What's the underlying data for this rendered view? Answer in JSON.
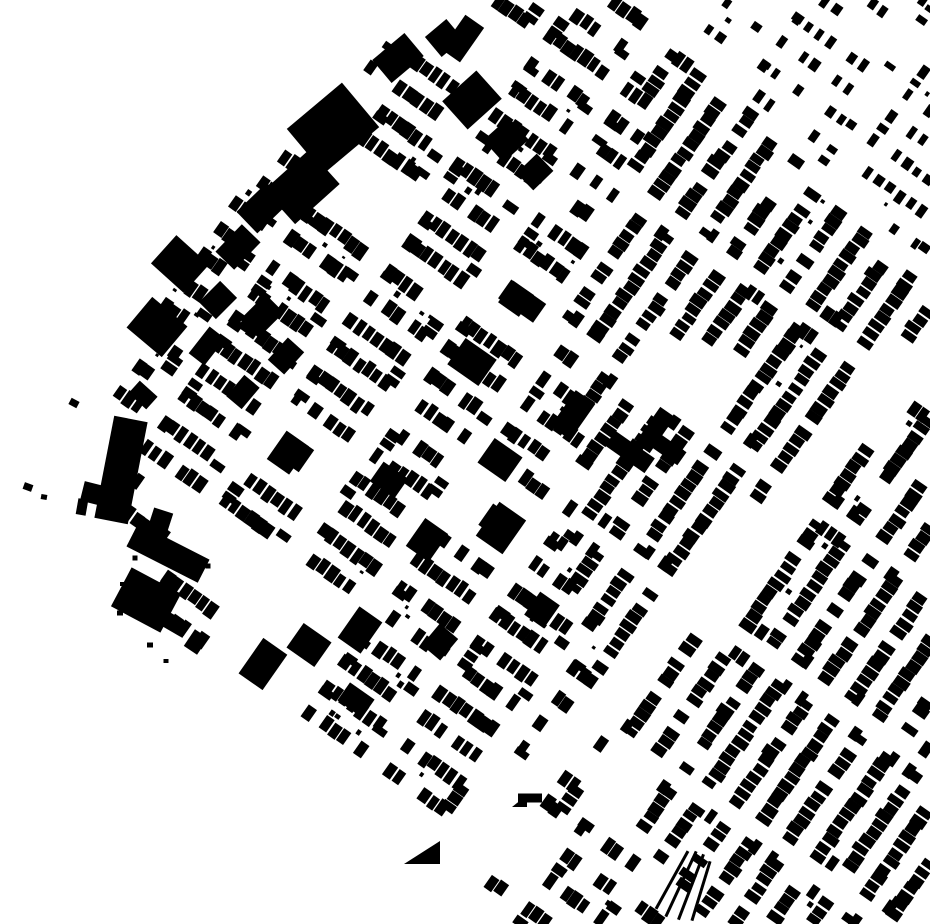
{
  "meta": {
    "description": "Black and white figure-ground map of urban building footprints: dense diagonal row-house grid, large industrial buildings along a north-west waterfront edge, a wide diagonal boulevard crossing the south-east, an empty park block right of center, a junction plaza at bottom and curved rail tracks at bottom center",
    "type": "figure-ground-map",
    "background": "#ffffff",
    "ink": "#000000",
    "width": 930,
    "height": 924,
    "seed": 1337
  },
  "districts": [
    {
      "name": "central-grid",
      "rotation": 35,
      "block_pitch_along": 96,
      "block_length": 80,
      "block_pitch_across": 63,
      "block_width": 45,
      "house_pitch": 10.5,
      "house_width": [
        7.5,
        11
      ],
      "house_depth": [
        13,
        16.5
      ],
      "skip_prob": 0.15,
      "end_prob": 0.35,
      "big_prob": 0.05,
      "empty_prob": 0.03,
      "speck_prob": 0.5,
      "phase": [
        12,
        8
      ],
      "polygon": [
        [
          430,
          0
        ],
        [
          648,
          0
        ],
        [
          648,
          128
        ],
        [
          610,
          210
        ],
        [
          560,
          300
        ],
        [
          590,
          430
        ],
        [
          560,
          560
        ],
        [
          612,
          700
        ],
        [
          578,
          764
        ],
        [
          700,
          924
        ],
        [
          520,
          924
        ],
        [
          470,
          860
        ],
        [
          420,
          810
        ],
        [
          330,
          755
        ],
        [
          225,
          695
        ],
        [
          160,
          620
        ],
        [
          95,
          540
        ],
        [
          103,
          418
        ],
        [
          148,
          340
        ],
        [
          185,
          265
        ],
        [
          255,
          180
        ],
        [
          340,
          95
        ]
      ]
    },
    {
      "name": "southeast-grid",
      "rotation": -55,
      "block_pitch_along": 150,
      "block_length": 134,
      "block_pitch_across": 64,
      "block_width": 47,
      "house_pitch": 10,
      "house_width": [
        7.5,
        10.5
      ],
      "house_depth": [
        13,
        16.5
      ],
      "skip_prob": 0.09,
      "end_prob": 0.4,
      "big_prob": 0.035,
      "empty_prob": 0.02,
      "speck_prob": 0.35,
      "phase": [
        30,
        6
      ],
      "polygon": [
        [
          648,
          0
        ],
        [
          930,
          290
        ],
        [
          930,
          924
        ],
        [
          706,
          924
        ],
        [
          582,
          762
        ],
        [
          612,
          700
        ],
        [
          560,
          560
        ],
        [
          590,
          430
        ],
        [
          560,
          300
        ],
        [
          610,
          210
        ],
        [
          648,
          128
        ]
      ]
    },
    {
      "name": "northeast-grid",
      "rotation": 35,
      "block_pitch_along": 132,
      "block_length": 114,
      "block_pitch_across": 57,
      "block_width": 41,
      "house_pitch": 13.5,
      "house_width": [
        6,
        9.5
      ],
      "house_depth": [
        9,
        13
      ],
      "skip_prob": 0.33,
      "end_prob": 0.25,
      "big_prob": 0.03,
      "empty_prob": 0.06,
      "speck_prob": 0.5,
      "phase": [
        55,
        20
      ],
      "polygon": [
        [
          646,
          0
        ],
        [
          930,
          0
        ],
        [
          930,
          292
        ]
      ]
    }
  ],
  "streets": [
    {
      "name": "boulevard-upper",
      "points": [
        [
          945,
          332
        ],
        [
          758,
          530
        ],
        [
          608,
          702
        ]
      ],
      "width": 46
    },
    {
      "name": "boulevard-lower",
      "points": [
        [
          608,
          702
        ],
        [
          560,
          756
        ],
        [
          468,
          830
        ],
        [
          352,
          924
        ]
      ],
      "width": 38
    },
    {
      "name": "south-branch",
      "points": [
        [
          574,
          760
        ],
        [
          700,
          932
        ]
      ],
      "width": 24
    },
    {
      "name": "park-block",
      "points": [
        [
          655,
          380
        ],
        [
          700,
          380
        ]
      ],
      "width": 76
    },
    {
      "name": "junction-plaza",
      "points": [
        [
          548,
          745
        ],
        [
          636,
          782
        ]
      ],
      "width": 40
    },
    {
      "name": "northeast-boundary-street",
      "points": [
        [
          648,
          -6
        ],
        [
          936,
          290
        ]
      ],
      "width": 16
    },
    {
      "name": "northeast-diagonal-street",
      "points": [
        [
          862,
          -5
        ],
        [
          800,
          120
        ],
        [
          770,
          230
        ]
      ],
      "width": 13
    }
  ],
  "landmarks": [
    [
      333,
      128,
      58,
      72,
      50
    ],
    [
      302,
      187,
      46,
      60,
      48
    ],
    [
      262,
      208,
      30,
      42,
      46
    ],
    [
      238,
      247,
      26,
      38,
      44
    ],
    [
      180,
      264,
      44,
      38,
      42
    ],
    [
      218,
      300,
      24,
      30,
      45
    ],
    [
      262,
      316,
      26,
      36,
      45
    ],
    [
      286,
      356,
      22,
      30,
      42
    ],
    [
      157,
      327,
      46,
      40,
      40
    ],
    [
      207,
      346,
      20,
      34,
      38
    ],
    [
      243,
      392,
      20,
      28,
      40
    ],
    [
      143,
      395,
      24,
      17,
      42
    ],
    [
      121,
      470,
      34,
      104,
      11
    ],
    [
      160,
      522,
      20,
      24,
      18
    ],
    [
      168,
      553,
      80,
      26,
      27
    ],
    [
      146,
      600,
      56,
      44,
      28
    ],
    [
      176,
      625,
      24,
      16,
      30
    ],
    [
      196,
      642,
      16,
      20,
      34
    ],
    [
      398,
      58,
      30,
      42,
      50
    ],
    [
      444,
      38,
      26,
      28,
      50
    ],
    [
      472,
      100,
      38,
      46,
      48
    ],
    [
      506,
      140,
      30,
      34,
      48
    ],
    [
      535,
      172,
      24,
      28,
      46
    ],
    [
      360,
      630,
      38,
      28,
      -55
    ],
    [
      440,
      642,
      28,
      24,
      -50
    ],
    [
      472,
      362,
      38,
      32,
      35
    ],
    [
      500,
      460,
      34,
      30,
      35
    ],
    [
      427,
      540,
      28,
      34,
      35
    ],
    [
      573,
      415,
      24,
      44,
      35
    ],
    [
      630,
      452,
      48,
      18,
      35
    ],
    [
      389,
      480,
      24,
      30,
      -55
    ],
    [
      309,
      645,
      30,
      34,
      -55
    ],
    [
      542,
      610,
      24,
      28,
      35
    ],
    [
      356,
      700,
      30,
      22,
      35
    ],
    [
      655,
      430,
      18,
      44,
      35
    ],
    [
      668,
      449,
      34,
      16,
      35
    ],
    [
      530,
      798,
      24,
      9,
      0
    ]
  ],
  "special_polygons": [
    {
      "name": "triangle-building",
      "points": [
        [
          404,
          864
        ],
        [
          440,
          841
        ],
        [
          440,
          864
        ]
      ]
    },
    {
      "name": "triangle-building-small",
      "points": [
        [
          512,
          807
        ],
        [
          527,
          795
        ],
        [
          527,
          807
        ]
      ]
    }
  ],
  "rails": [
    [
      672,
      880,
      3,
      66,
      29
    ],
    [
      681,
      884,
      3,
      72,
      25
    ],
    [
      691,
      887,
      3,
      70,
      21
    ],
    [
      701,
      891,
      3,
      62,
      17
    ]
  ],
  "scatter": [
    [
      28,
      487,
      9,
      7,
      20
    ],
    [
      44,
      497,
      6,
      5,
      10
    ],
    [
      95,
      494,
      26,
      20,
      14
    ],
    [
      82,
      507,
      10,
      16,
      10
    ],
    [
      74,
      403,
      9,
      7,
      28
    ],
    [
      135,
      558,
      5,
      5,
      0
    ],
    [
      122,
      584,
      4,
      4,
      0
    ],
    [
      150,
      645,
      6,
      5,
      0
    ],
    [
      166,
      661,
      5,
      4,
      0
    ],
    [
      208,
      566,
      5,
      5,
      0
    ],
    [
      120,
      613,
      6,
      5,
      0
    ]
  ]
}
